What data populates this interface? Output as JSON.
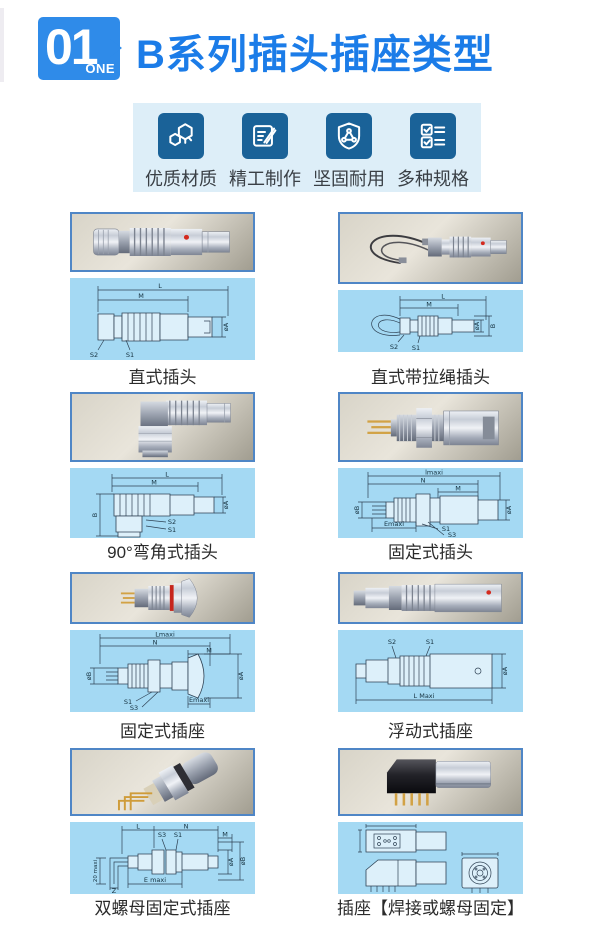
{
  "header": {
    "badge_number": "01",
    "badge_word": "ONE",
    "title": "B系列插头插座类型"
  },
  "features": {
    "items": [
      {
        "label": "优质材质",
        "icon": "hexagons-icon"
      },
      {
        "label": "精工制作",
        "icon": "notepad-pen-icon"
      },
      {
        "label": "坚固耐用",
        "icon": "shield-triangle-icon"
      },
      {
        "label": "多种规格",
        "icon": "checklist-icon"
      }
    ]
  },
  "catalog": {
    "items": [
      {
        "label": "直式插头",
        "dims": [
          "L",
          "M",
          "øA",
          "S2",
          "S1"
        ]
      },
      {
        "label": "直式带拉绳插头",
        "dims": [
          "L",
          "M",
          "øA",
          "B",
          "S2",
          "S1"
        ]
      },
      {
        "label": "90°弯角式插头",
        "dims": [
          "L",
          "M",
          "B",
          "øA",
          "S2",
          "S1"
        ]
      },
      {
        "label": "固定式插头",
        "dims": [
          "lmaxi",
          "N",
          "M",
          "øB",
          "øA",
          "S1",
          "S3",
          "Emaxi"
        ]
      },
      {
        "label": "固定式插座",
        "dims": [
          "Lmaxi",
          "N",
          "M",
          "øB",
          "øA",
          "S1",
          "S3",
          "Emaxi"
        ]
      },
      {
        "label": "浮动式插座",
        "dims": [
          "S2",
          "S1",
          "øA",
          "L  Maxi"
        ]
      },
      {
        "label": "双螺母固定式插座",
        "dims": [
          "L",
          "N",
          "S3",
          "S1",
          "M",
          "20 maxi",
          "E  maxi",
          "Z",
          "øA",
          "øB"
        ]
      },
      {
        "label": "插座【焊接或螺母固定】",
        "dims": []
      }
    ]
  },
  "colors": {
    "badge_blue": "#2f8be9",
    "title_blue": "#1b7ce8",
    "icon_navy": "#1a6298",
    "strip_bg": "#ddeef8",
    "drawing_bg": "#a4d9f3",
    "photo_border": "#4f86c6",
    "red_dot": "#d42a1e"
  }
}
